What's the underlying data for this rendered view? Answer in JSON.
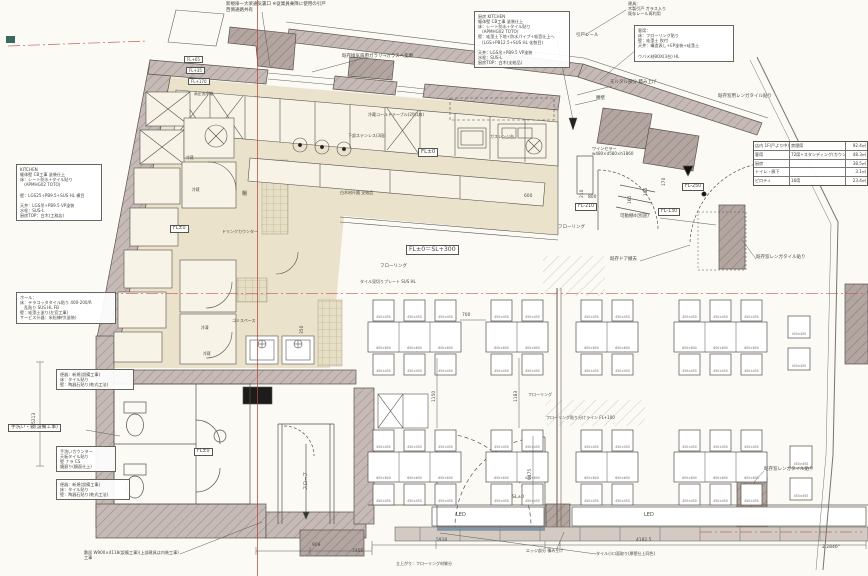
{
  "colors": {
    "paper": "#fbfaf5",
    "wall_fill": "#c6bab6",
    "wall_dark": "#b2a5a0",
    "kitchen_fill": "#eae2cb",
    "accent_red": "#b5493f",
    "line": "#4c4a45",
    "blue_threshold": "#6f9cc9"
  },
  "spec_table": {
    "rows": [
      {
        "label": "店内 1F(戸より中)",
        "detail": "禁煙席",
        "area": "92.4㎡"
      },
      {
        "label": "客席",
        "detail": "72席+スタンディング(カウンター含12席)",
        "area": "48.3㎡"
      },
      {
        "label": "厨房",
        "detail": "",
        "area": "38.5㎡"
      },
      {
        "label": "トイレ・廊下",
        "detail": "",
        "area": "3.1㎡"
      },
      {
        "label": "ピロティ",
        "detail": "16席",
        "area": "23.4㎡"
      }
    ]
  },
  "notes": {
    "top_door": "新規扉一大梁通気裏口 ※従業員乗降に使用の引戸\n西側通路共有",
    "kitchen_spec_top": "厨房 KITCHEN\n躯体壁 CB工事 塗装仕上\n床：シート防水+タイル貼り\n　(APMHG02 TOTO)\n壁：珪藻土下地+防水パイプ+吸音仕上へ\n　(LGS+PB12.5+SUS HL 化粧目)\n\n天井：LGS吊+PB9.5 VP塗装\n水栓：SUS-L\n厨房TOP：白木(支給品)",
    "seating_spec": "客席：\n床：フローリング貼り\n壁：珪藻土 吹付\n天井：構造表し+EP塗装+珪藻土\n\nウバメ材BOX(3台) HL",
    "kitchen_spec_left": "KITCHEN\n躯体壁 CB工事 塗装仕上\n床：シート防水+タイル貼り\n　(APMHG02 TOTO)\n\n壁：LGS25+PB9.5+SUS HL 横目\n\n天井：LGS吊+PB9.5 VP塗装\n水栓：SUS-L\n厨房TOP：白木(工務店)",
    "hall_spec": "ホール：\n床：テラコッタタイル貼り 400-200/R\n　乱貼り SUS HL FB\n壁：珪藻土塗り(左官工事)\nサービス什器：米松練付(塗装)",
    "toilet_spec_1": "便器：新規(設備工事)\n床：タイル貼り\n壁：陶器石貼り(乾式工法)",
    "hand_wash": "手洗い・鏡(設備工事)",
    "hand_counter": "手洗いカウンター\n天板タイル貼り\n壁 ナラ CS\n鏡廻り(鏡面仕上)",
    "toilet_spec_2": "便器：新規(設備工事)\n床：タイル貼り\n壁：陶器石貼り(乾式工法)",
    "sill_note": "敷居 W900×4118(設備工事)(上部建具は内装工事)\n工事",
    "glass_note": "既存換気扇用ガラリ→ガラスへ変更",
    "door_note_right": "建具：\n木製引戸 ガラス入り\n既存レール再利用"
  },
  "labels": {
    "fl0_sl300": "FL±0＝SL+300",
    "fl0": "FL±0",
    "fl_minus_210": "FL-210",
    "fl_minus_130": "FL-130",
    "fl_minus_250": "FL-250",
    "fl_plus_65": "FL+65",
    "fl_plus_35": "FL+35",
    "fl_plus_170": "FL+170",
    "sl0": "SL±0",
    "hikido_rail": "引戸レール",
    "mortar": "モルタル部分 積み上げ",
    "koshikabe": "腰壁",
    "brick_top": "既存窓用レンガタイル貼り",
    "brick_mid": "既存窓レンガタイル貼り",
    "brick_bottom": "既存窓レンガタイル貼り",
    "wine_cellar": "ワインセラー\nw480×d580×h1860",
    "movable_shelf": "可動棚4(別途)",
    "door_removed": "既存ドア撤去",
    "flooring": "フローリング",
    "tile_plate": "タイル見切りプレート SUS HL",
    "cold_table": "冷蔵コールドテーブル(2列1扉)",
    "under_stainless": "下部ステンレス(3段)",
    "gas_range": "ガスレンジ台",
    "shiraki": "白木材什器 支給品",
    "shelf": "棚",
    "drink_counter": "ドリンクカウンター",
    "gomi": "ゴミスペース",
    "reizo": "冷蔵",
    "reito": "冷凍",
    "kouatsu": "高圧洗浄機",
    "slope": "スロープ",
    "led": "LED",
    "edge_note": "エッジ部分 積み上げ",
    "tile_edge_note": "タイル小口面取り(厚壁仕上同色)",
    "rise_note": "立上がり：フローリング材質分",
    "flooring_line_note": "フローリング貼り分けライン FL+100",
    "angle": "2.2846°"
  },
  "dims": {
    "d600": "600",
    "d800": "800",
    "d700": "700",
    "d1150": "1150",
    "d1183": "1183",
    "d9475": "9475",
    "d908": "908",
    "d5918": "5918",
    "d41825": "4182.5",
    "d7455": "7455",
    "d5213": "5213",
    "d210": "210",
    "d185": "185",
    "d165": "165",
    "d170": "170",
    "d350": "350"
  },
  "table_sizes": {
    "table": "600×600",
    "chair": "450×450"
  }
}
